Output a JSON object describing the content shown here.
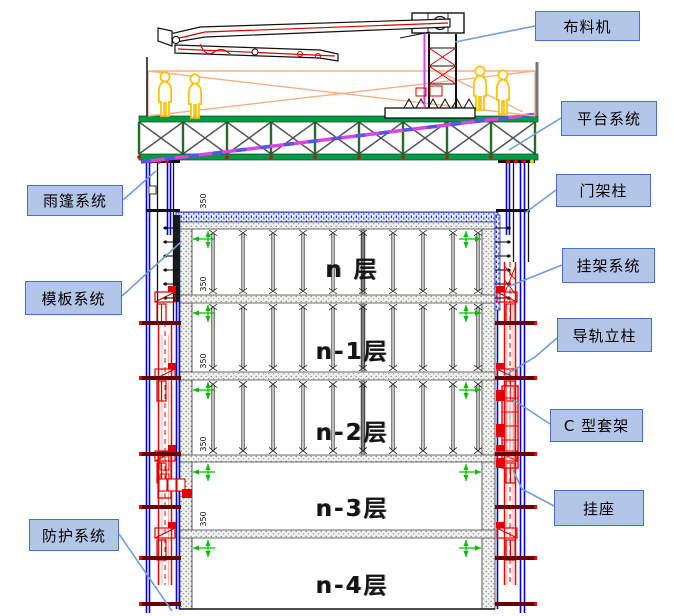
{
  "diagram_title": "",
  "annotations": {
    "right": [
      {
        "label": "布料机"
      },
      {
        "label": "平台系统"
      },
      {
        "label": "门架柱"
      },
      {
        "label": "挂架系统"
      },
      {
        "label": "导轨立柱"
      },
      {
        "label": "C 型套架"
      },
      {
        "label": "挂座"
      }
    ],
    "left": [
      {
        "label": "雨篷系统"
      },
      {
        "label": "模板系统"
      },
      {
        "label": "防护系统"
      }
    ]
  },
  "floors": [
    {
      "label": "n 层"
    },
    {
      "label": "n-1层"
    },
    {
      "label": "n-2层"
    },
    {
      "label": "n-3层"
    },
    {
      "label": "n-4层"
    }
  ],
  "dimensions": {
    "slab_dim": "350"
  },
  "colors": {
    "callout_fill": "#b4c6e7",
    "callout_border": "#4472c4",
    "leader_line": "#6f9fd8",
    "platform_green": "#009a44",
    "column_blue": "#0000dd",
    "rail_red": "#ee0000",
    "bar_dark_red": "#6b0000",
    "pump_pipe_magenta": "#dd44dd",
    "guardrail_orange": "#f5b183",
    "worker_yellow": "#ffc000",
    "fresh_slab_blue": "#2233cc"
  }
}
